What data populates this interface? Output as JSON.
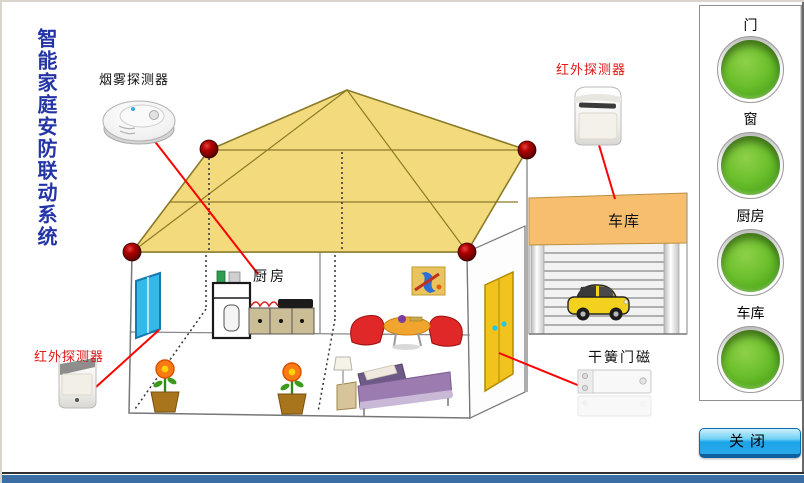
{
  "title": {
    "text": "智能家庭安防联动系统",
    "color": "#2434a6"
  },
  "diagram": {
    "labels": {
      "smoke_detector": "烟雾探测器",
      "infrared_top": "红外探测器",
      "infrared_bottom": "红外探测器",
      "reed_switch": "干簧门磁",
      "kitchen": "厨房",
      "garage": "车库"
    },
    "colors": {
      "roof": "#f3db7d",
      "roof_line": "#8a7a28",
      "alarm_node": "#8b0000",
      "connector_line": "#ff0000",
      "garage_roof": "#f7be6e",
      "window": "#35b9e9",
      "door": "#f2c31c"
    }
  },
  "panel": {
    "indicators": [
      {
        "label": "门",
        "state": "on",
        "color": "#5cb424"
      },
      {
        "label": "窗",
        "state": "on",
        "color": "#5cb424"
      },
      {
        "label": "厨房",
        "state": "on",
        "color": "#5cb424"
      },
      {
        "label": "车库",
        "state": "on",
        "color": "#5cb424"
      }
    ]
  },
  "close_button": {
    "label": "关闭",
    "color": "#1ba4e9"
  },
  "footer": {
    "strip_color": "#3a6ea5"
  }
}
